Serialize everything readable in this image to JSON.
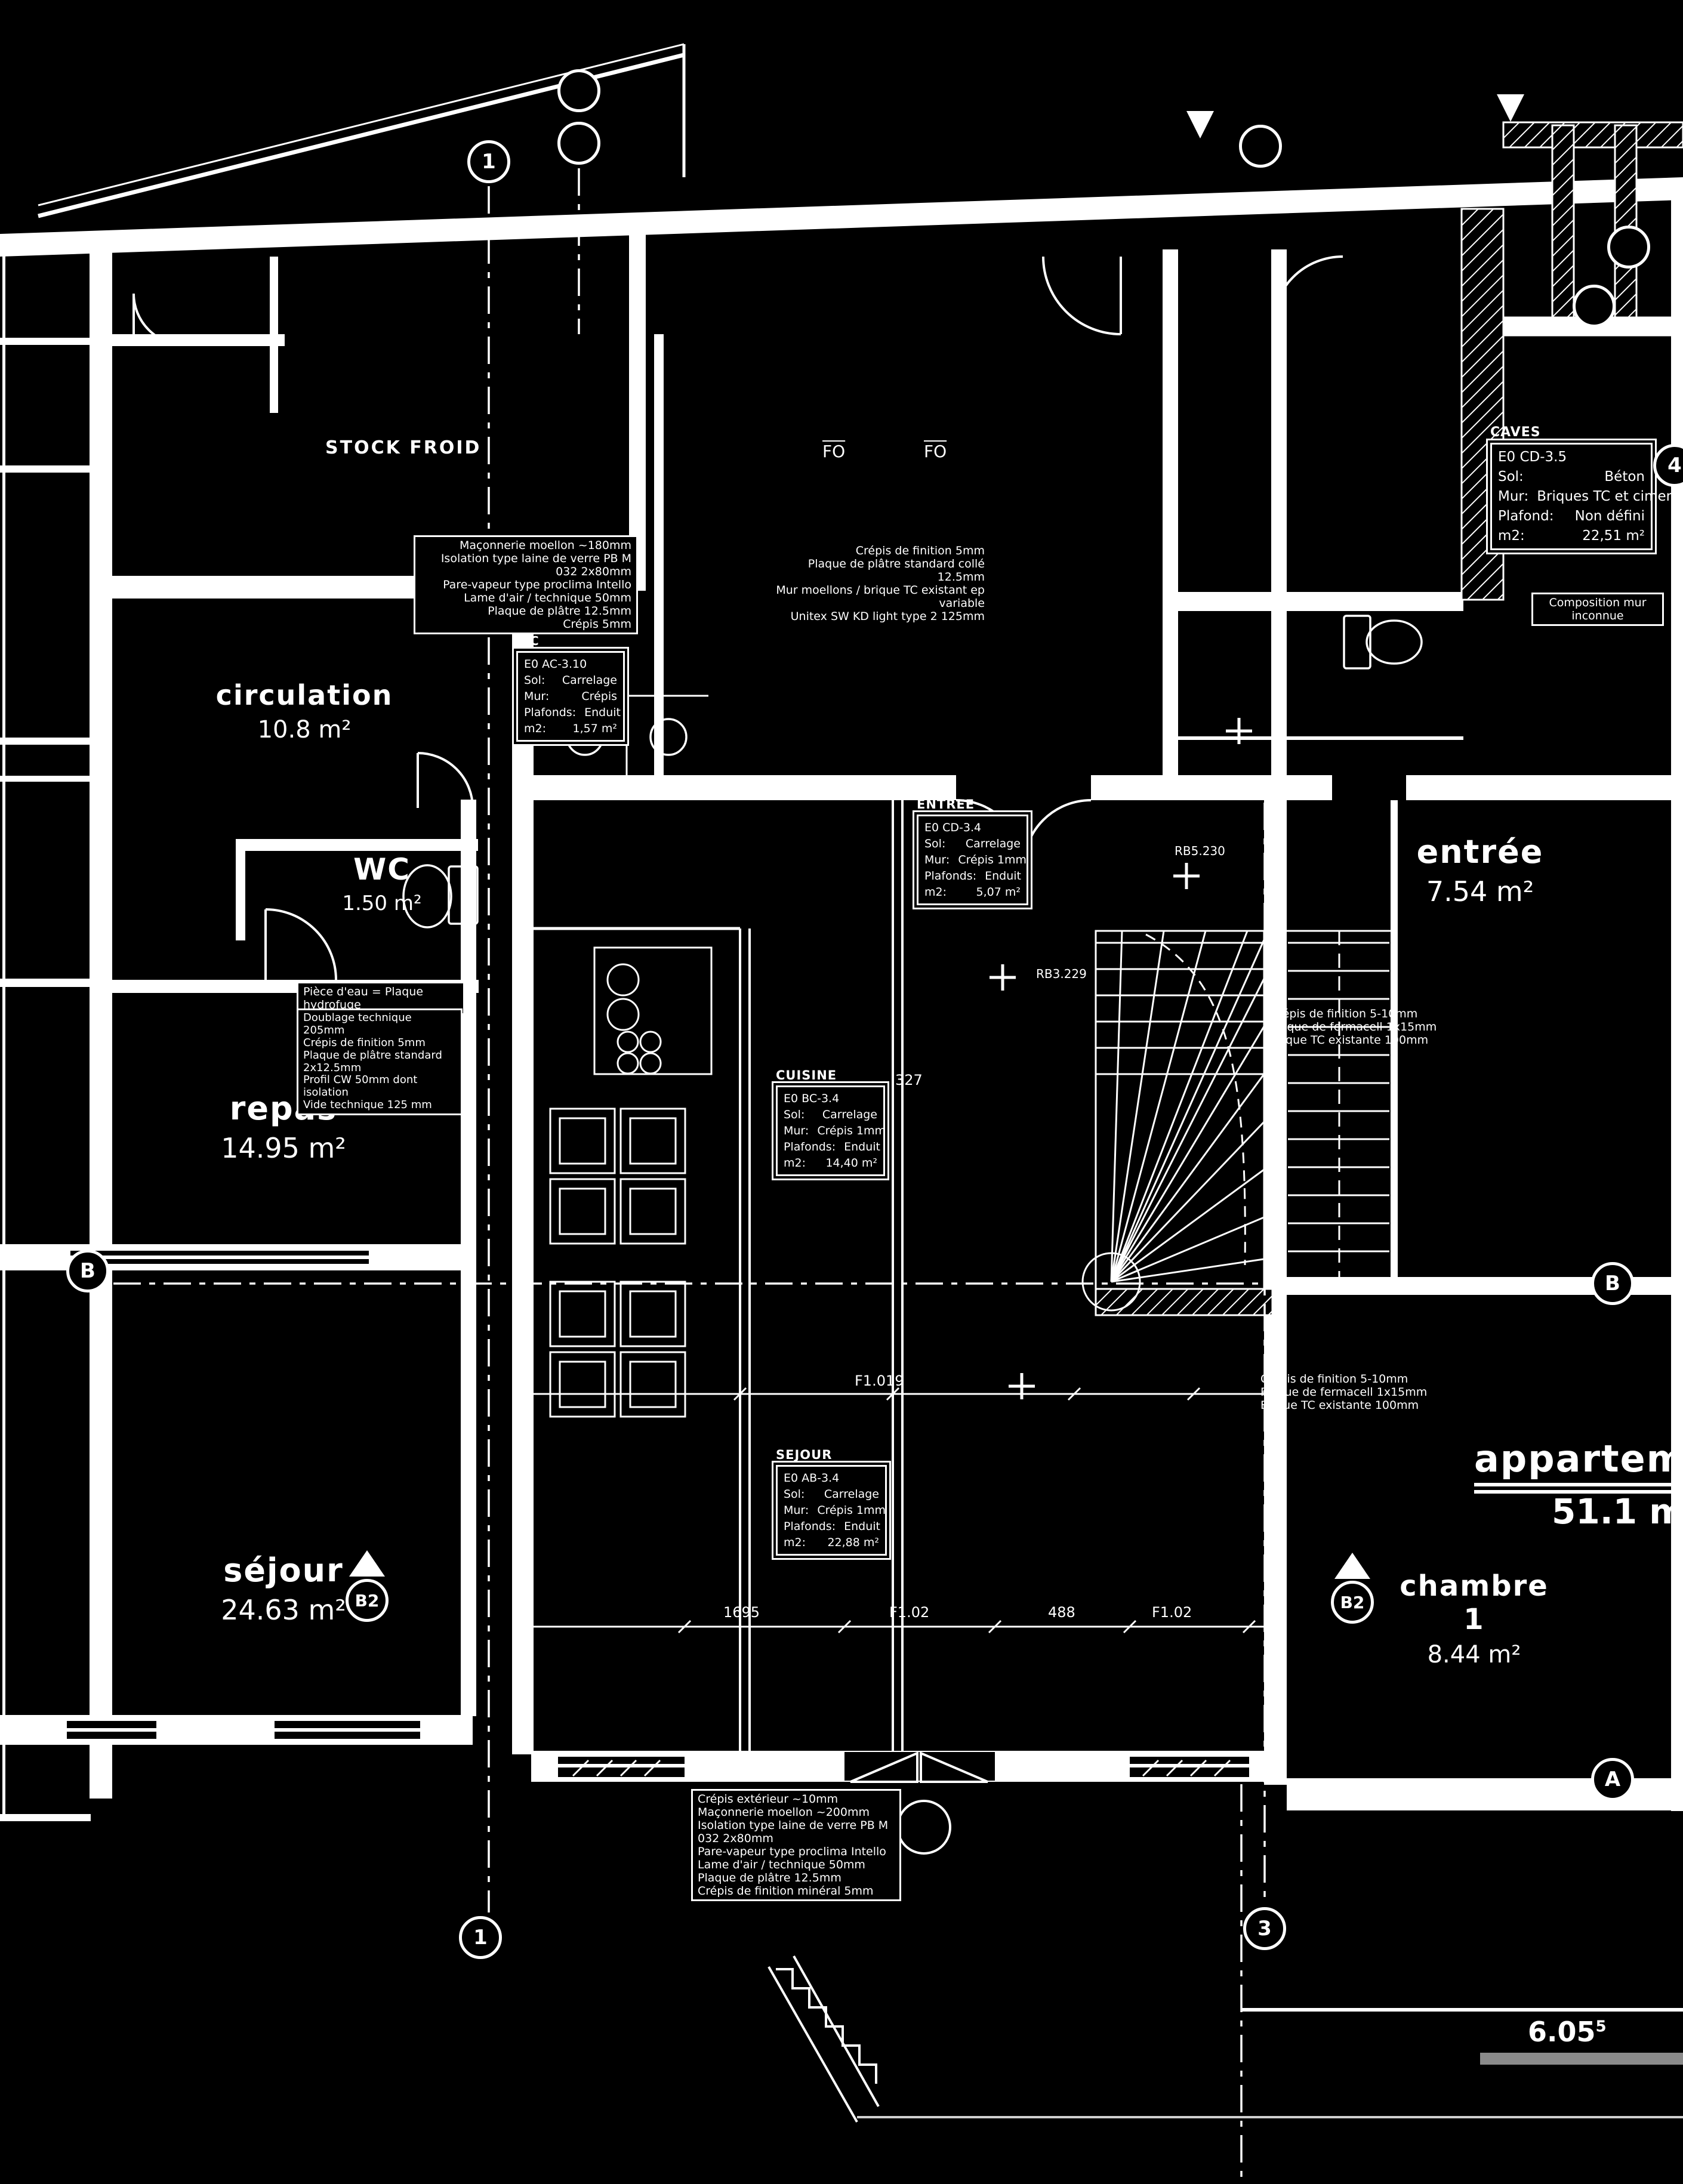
{
  "rooms": [
    {
      "label": "STOCK FROID",
      "area": ""
    },
    {
      "label": "circulation",
      "area": "10.8 m²"
    },
    {
      "label": "WC",
      "area": "1.50 m²"
    },
    {
      "label": "repas",
      "area": "14.95 m²"
    },
    {
      "label": "séjour",
      "area": "24.63 m²"
    },
    {
      "label": "entrée",
      "area": "7.54 m²"
    },
    {
      "label": "chambre 1",
      "area": "8.44 m²"
    },
    {
      "label": "appartement",
      "area": "51.1 m²"
    },
    {
      "label": "FO",
      "area": ""
    },
    {
      "label": "FO",
      "area": ""
    }
  ],
  "info_boxes": [
    {
      "title": "CAVES",
      "code": "E0 CD-3.5",
      "rows": [
        [
          "Sol:",
          "Béton"
        ],
        [
          "Mur:",
          "Briques TC et ciment"
        ],
        [
          "Plafond:",
          "Non défini"
        ],
        [
          "m2:",
          "22,51 m²"
        ]
      ]
    },
    {
      "title": "WC",
      "code": "E0 AC-3.10",
      "rows": [
        [
          "Sol:",
          "Carrelage"
        ],
        [
          "Mur:",
          "Crépis"
        ],
        [
          "Plafonds:",
          "Enduit"
        ],
        [
          "m2:",
          "1,57 m²"
        ]
      ]
    },
    {
      "title": "ENTREE",
      "code": "E0 CD-3.4",
      "rows": [
        [
          "Sol:",
          "Carrelage"
        ],
        [
          "Mur:",
          "Crépis 1mm"
        ],
        [
          "Plafonds:",
          "Enduit"
        ],
        [
          "m2:",
          "5,07 m²"
        ]
      ]
    },
    {
      "title": "CUISINE",
      "code": "E0 BC-3.4",
      "rows": [
        [
          "Sol:",
          "Carrelage"
        ],
        [
          "Mur:",
          "Crépis 1mm"
        ],
        [
          "Plafonds:",
          "Enduit"
        ],
        [
          "m2:",
          "14,40 m²"
        ]
      ]
    },
    {
      "title": "SEJOUR",
      "code": "E0 AB-3.4",
      "rows": [
        [
          "Sol:",
          "Carrelage"
        ],
        [
          "Mur:",
          "Crépis 1mm"
        ],
        [
          "Plafonds:",
          "Enduit"
        ],
        [
          "m2:",
          "22,88 m²"
        ]
      ]
    }
  ],
  "annotations": {
    "wall_left_top": [
      "Maçonnerie moellon ~180mm",
      "Isolation type laine de verre PB M 032 2x80mm",
      "Pare-vapeur type proclima Intello",
      "Lame d'air / technique 50mm",
      "Plaque de plâtre 12.5mm",
      "Crépis 5mm"
    ],
    "wall_mid_top": [
      "Crépis de finition  5mm",
      "Plaque de plâtre standard collé  12.5mm",
      "Mur moellons / brique TC existant  ep variable",
      "Unitex SW KD light type 2  125mm"
    ],
    "piece_eau": "Pièce d'eau = Plaque hydrofuge",
    "doublage": [
      "Doublage technique 205mm",
      "Crépis de finition 5mm",
      "Plaque de plâtre standard 2x12.5mm",
      "Profil CW 50mm dont isolation",
      "Vide technique 125 mm"
    ],
    "wall_right": [
      "Crépis de finition 5-10mm",
      "Plaque de fermacell 1x15mm",
      "Brique TC existante 100mm"
    ],
    "wall_right_lower": [
      "Crépis de finition 5-10mm",
      "Plaque de fermacell 1x15mm",
      "Brique TC existante 100mm"
    ],
    "wall_bottom": [
      "Crépis extérieur ~10mm",
      "Maçonnerie moellon ~200mm",
      "Isolation type laine de verre PB M 032 2x80mm",
      "Pare-vapeur type proclima Intello",
      "Lame d'air / technique 50mm",
      "Plaque de plâtre 12.5mm",
      "Crépis de finition minéral 5mm"
    ],
    "composition_note": "Composition mur inconnue"
  },
  "markers": [
    {
      "label": "1"
    },
    {
      "label": "1"
    },
    {
      "label": "3"
    },
    {
      "label": "4"
    },
    {
      "label": "B"
    },
    {
      "label": "B"
    },
    {
      "label": "A"
    },
    {
      "label": "B2"
    },
    {
      "label": "B2"
    },
    {
      "label": ""
    },
    {
      "label": ""
    },
    {
      "label": ""
    },
    {
      "label": ""
    }
  ],
  "dims": [
    "327",
    "1695",
    "F1.02",
    "488",
    "F1.02",
    "F1.019",
    "RB5.230",
    "RB3.229"
  ],
  "levels": {
    "ground": "6.05",
    "ground_sup": "5"
  },
  "colors": {
    "background": "#000000",
    "lines": "#ffffff",
    "terrain": "#8a8a8a"
  }
}
